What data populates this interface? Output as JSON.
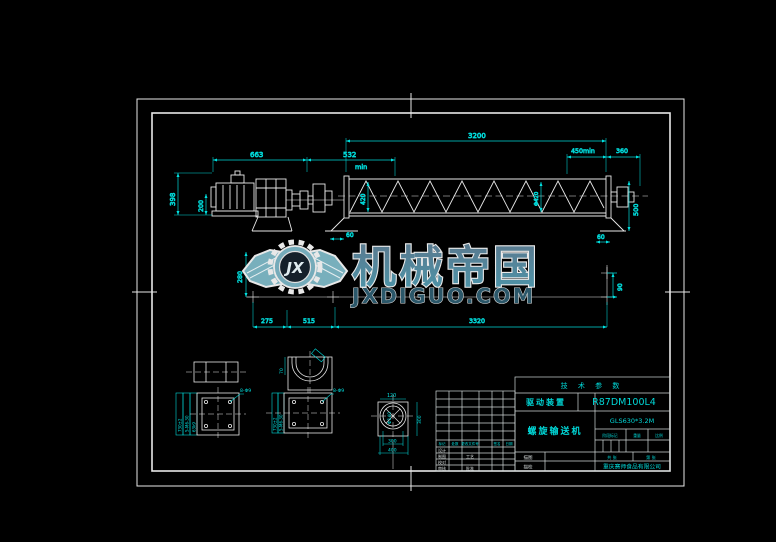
{
  "watermark": {
    "brand": "机械帝国",
    "domain": "JXDIGUO.COM",
    "monogram": "JX"
  },
  "dimensions": {
    "top_total": "3200",
    "motor_len": "663",
    "coupling_len": "532",
    "right_min": "450min",
    "right_end": "360",
    "min_note": "min",
    "motor_height": "398",
    "motor_center": "200",
    "screw_dia_left": "420",
    "screw_dia_right": "Φ420",
    "right_height": "500",
    "left_gap": "60",
    "right_gap": "60",
    "base_height": "280",
    "base_a": "275",
    "base_b": "515",
    "base_total": "3320",
    "anchor_spacing": "90"
  },
  "details": {
    "flange_left": {
      "rot_labels": [
        "730±2",
        "5-M6-30",
        "63k9"
      ],
      "leader": "8-Φ9"
    },
    "flange_right": {
      "rot_labels": [
        "730±2",
        "5-M6-30"
      ],
      "leader": "8-Φ9"
    },
    "trough_section": {
      "side": "70"
    },
    "end_view": {
      "top": "120",
      "right": "300",
      "bottom_inner": "300",
      "bottom_outer": "400",
      "bore": "Φ140"
    }
  },
  "title_block": {
    "tech_params": "技 术 参 数",
    "drive_label": "驱动装置",
    "drive_model": "R87DM100L4",
    "product_name": "螺旋输送机",
    "product_model": "GLS630*3.2M",
    "stage_mark": "阶段标记",
    "weight": "重量",
    "scale": "比例",
    "sheets_total": "共 张",
    "sheet_no": "第 张",
    "company": "重庆赛师食品有限公司",
    "trace_draw": "描图",
    "trace_check": "描校",
    "sig_header": [
      "标记",
      "处数",
      "更改文件号",
      "签名",
      "日期"
    ],
    "sig_col1": [
      "设计",
      "制图",
      "校对",
      "审核"
    ],
    "sig_col2": [
      "工艺",
      "批准"
    ]
  },
  "colors": {
    "dim": "#00e2e2",
    "line": "#e8e8e8",
    "wm_fill_top": "#5d7e93",
    "wm_fill_bottom": "#4f9ab0",
    "wm_domain": "#2d5a6d"
  }
}
